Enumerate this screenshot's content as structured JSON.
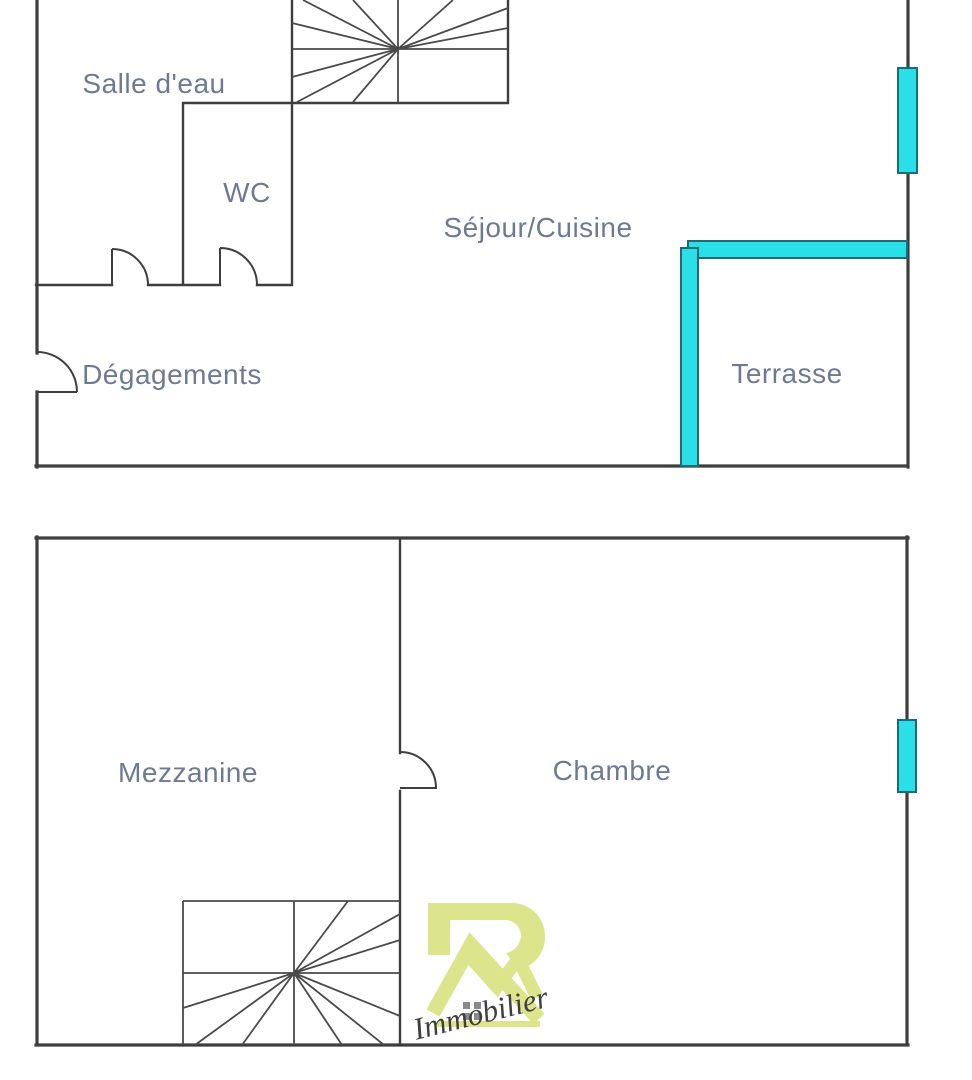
{
  "plan": {
    "floors": [
      {
        "id": "main-level",
        "rooms": [
          {
            "label": "Salle d'eau"
          },
          {
            "label": "WC"
          },
          {
            "label": "Séjour/Cuisine"
          },
          {
            "label": "Dégagements"
          },
          {
            "label": "Terrasse"
          }
        ]
      },
      {
        "id": "mezzanine-level",
        "rooms": [
          {
            "label": "Mezzanine"
          },
          {
            "label": "Chambre"
          }
        ]
      }
    ]
  },
  "watermark": {
    "script": "Immobilier"
  },
  "colors": {
    "wall": "#3e3e3e",
    "stair": "#4a4a4a",
    "glazing_fill": "#2bdfe9",
    "glazing_stroke": "#1d6b74",
    "label_text": "#6e7a94",
    "logo_fill": "#dde58c",
    "logo_window": "#8a8a8a",
    "script_ink": "#3f3f3f",
    "background": "#ffffff"
  }
}
